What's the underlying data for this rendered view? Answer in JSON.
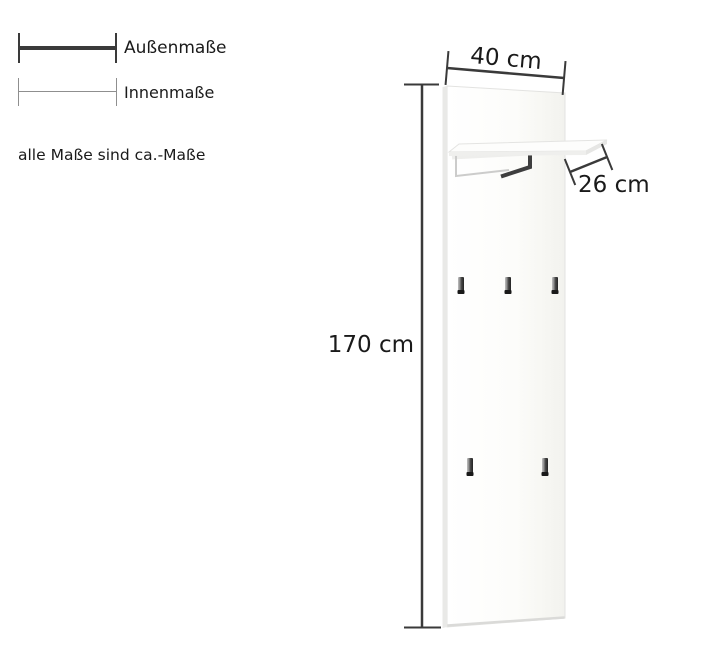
{
  "legend": {
    "outer_label": "Außenmaße",
    "inner_label": "Innenmaße",
    "note": "alle Maße sind ca.-Maße"
  },
  "dimensions": {
    "width": "40 cm",
    "depth": "26 cm",
    "height": "170 cm"
  },
  "product": {
    "hooks_top_row": 3,
    "hooks_bottom_row": 2
  },
  "colors": {
    "dimension_line": "#3a3a3a",
    "inner_legend_line": "#8f8f8f",
    "panel_edge": "#e3e3e1",
    "background": "#ffffff",
    "text": "#1a1a1a"
  }
}
